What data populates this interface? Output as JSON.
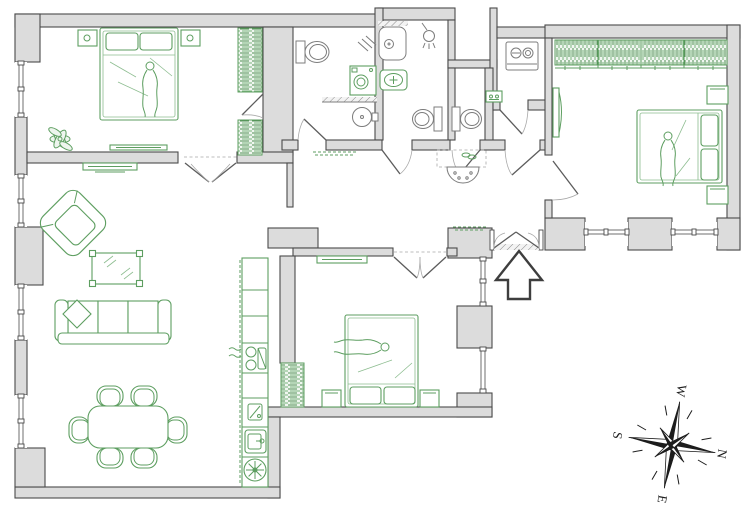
{
  "canvas": {
    "width": 750,
    "height": 511
  },
  "colors": {
    "bg": "#ffffff",
    "wall_fill": "#dcdcdc",
    "wall_stroke": "#4a4a4a",
    "furn": "#5d9e60",
    "furn_light": "#8dbd90",
    "compass": "#1c1c1c"
  },
  "compass": {
    "labels": {
      "west": "W",
      "north": "N",
      "east": "E",
      "south": "S"
    },
    "rotation_deg": 100
  },
  "entrance": {
    "direction": "up"
  },
  "rooms": [
    "bedroom-1",
    "living-room",
    "dining-area",
    "kitchen",
    "bathroom",
    "shower-room",
    "wc",
    "utility-room",
    "hallway",
    "entrance-corridor",
    "bedroom-2",
    "bedroom-3"
  ],
  "furniture_icons": [
    "double-bed",
    "pillow",
    "nightstand",
    "wardrobe",
    "plant",
    "tv-unit",
    "armchair",
    "coffee-table",
    "sofa",
    "throw-pillow",
    "dining-table",
    "chair",
    "cooktop",
    "kitchen-sink",
    "extractor-fan",
    "toilet",
    "washbasin",
    "washing-machine",
    "shower",
    "towel-radiator",
    "console-table",
    "compass-rose",
    "entrance-arrow"
  ]
}
